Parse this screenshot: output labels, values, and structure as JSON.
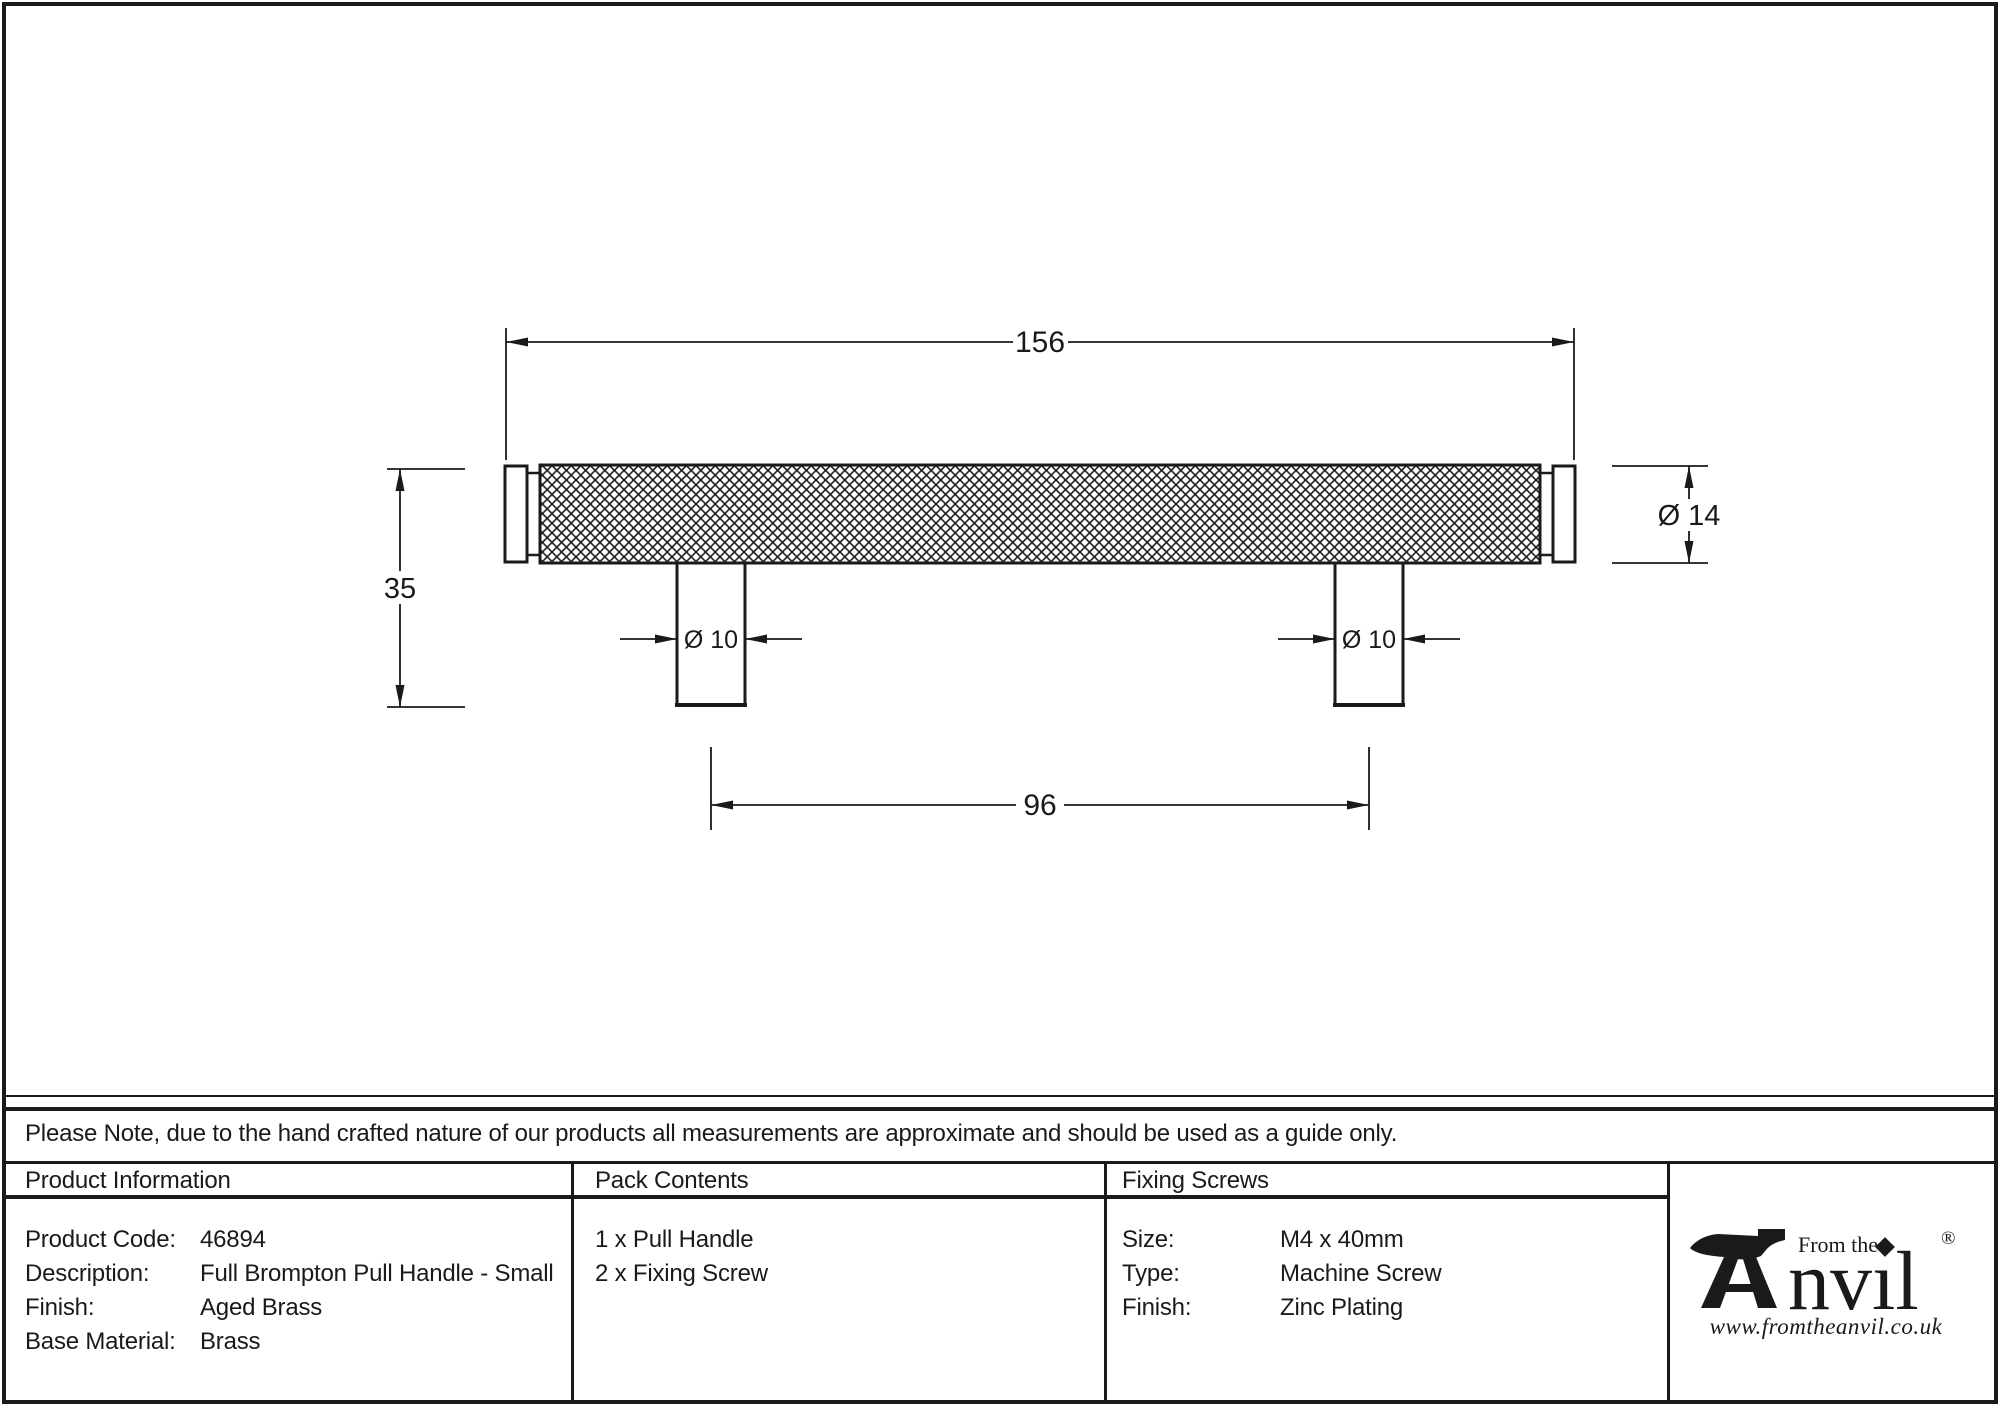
{
  "drawing": {
    "dim_overall_length": "156",
    "dim_overall_height": "35",
    "dim_fixing_centres": "96",
    "dim_bar_diameter": "Ø 14",
    "dim_post_diameter_left": "Ø 10",
    "dim_post_diameter_right": "Ø 10"
  },
  "note": {
    "text": "Please Note, due to the hand crafted nature of our products all measurements are approximate and should be used as a guide only."
  },
  "table": {
    "product_information": {
      "header": "Product Information",
      "rows": [
        {
          "label": "Product Code:",
          "value": "46894"
        },
        {
          "label": "Description:",
          "value": "Full Brompton Pull Handle - Small"
        },
        {
          "label": "Finish:",
          "value": "Aged Brass"
        },
        {
          "label": "Base Material:",
          "value": "Brass"
        }
      ]
    },
    "pack_contents": {
      "header": "Pack Contents",
      "items": [
        "1 x Pull Handle",
        "2 x Fixing Screw"
      ]
    },
    "fixing_screws": {
      "header": "Fixing Screws",
      "rows": [
        {
          "label": "Size:",
          "value": "M4 x 40mm"
        },
        {
          "label": "Type:",
          "value": "Machine Screw"
        },
        {
          "label": "Finish:",
          "value": "Zinc Plating"
        }
      ]
    }
  },
  "logo": {
    "brand": "Anvil",
    "prefix": "From the",
    "brand_suffix_glyphs": "nvıl",
    "registered": "®",
    "website": "www.fromtheanvil.co.uk"
  },
  "colors": {
    "ink": "#1a1a1a",
    "background": "#ffffff"
  }
}
